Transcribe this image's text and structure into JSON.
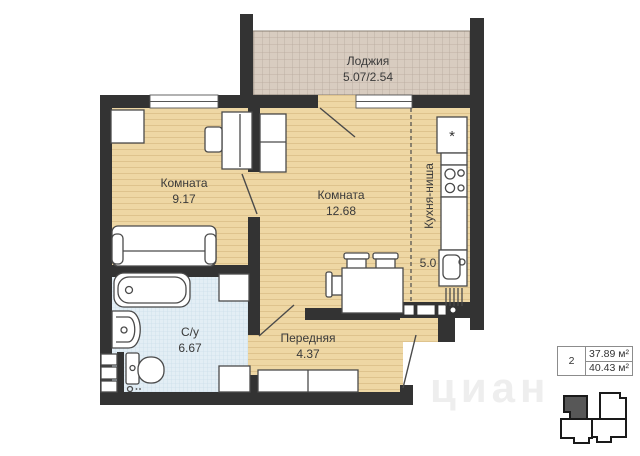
{
  "plan": {
    "rooms": [
      {
        "name": "Лоджия",
        "area": "5.07/2.54"
      },
      {
        "name": "Комната",
        "area": "9.17"
      },
      {
        "name": "Комната",
        "area": "12.68"
      },
      {
        "name": "Кухня-ниша",
        "area": "5.0"
      },
      {
        "name": "С/у",
        "area": "6.67"
      },
      {
        "name": "Передняя",
        "area": "4.37"
      }
    ],
    "fridge_symbol": "*"
  },
  "info_panel": {
    "rooms_count": "2",
    "living_area": "37.89 м²",
    "total_area": "40.43 м²"
  },
  "watermark": "циан",
  "colors": {
    "wall": "#333333",
    "floor": "#eed7a4",
    "loggia_floor": "#d8ccc0",
    "bath_floor": "#e3eef5",
    "furniture_outline": "#4a4a4a",
    "highlight_unit": "#575757"
  }
}
